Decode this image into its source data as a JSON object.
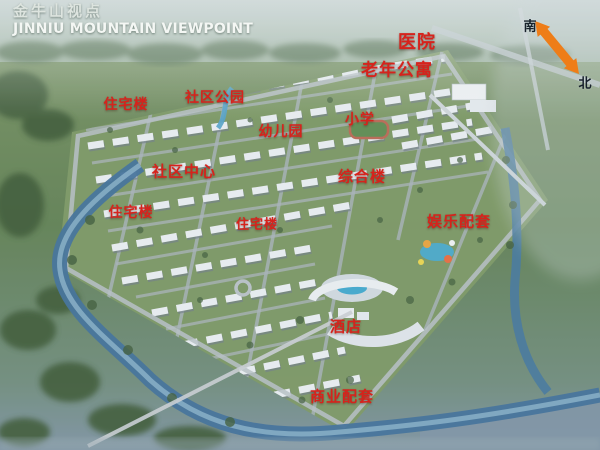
{
  "title": {
    "zh": "金牛山视点",
    "en": "JINNIU MOUNTAIN VIEWPOINT"
  },
  "compass": {
    "arrow_color": "#ee7d18",
    "south": {
      "text": "南",
      "x": 530,
      "y": 25
    },
    "north": {
      "text": "北",
      "x": 585,
      "y": 82
    }
  },
  "labels": [
    {
      "text": "医院",
      "x": 417,
      "y": 41,
      "size": 18
    },
    {
      "text": "老年公寓",
      "x": 397,
      "y": 68,
      "size": 17
    },
    {
      "text": "住宅楼",
      "x": 126,
      "y": 104,
      "size": 14
    },
    {
      "text": "社区公园",
      "x": 215,
      "y": 97,
      "size": 14
    },
    {
      "text": "小学",
      "x": 360,
      "y": 119,
      "size": 14
    },
    {
      "text": "幼儿园",
      "x": 281,
      "y": 131,
      "size": 14
    },
    {
      "text": "社区中心",
      "x": 184,
      "y": 171,
      "size": 15
    },
    {
      "text": "综合楼",
      "x": 362,
      "y": 176,
      "size": 15
    },
    {
      "text": "住宅楼",
      "x": 131,
      "y": 212,
      "size": 14
    },
    {
      "text": "住宅楼",
      "x": 257,
      "y": 223,
      "size": 13
    },
    {
      "text": "娱乐配套",
      "x": 459,
      "y": 221,
      "size": 15
    },
    {
      "text": "酒店",
      "x": 346,
      "y": 326,
      "size": 15
    },
    {
      "text": "商业配套",
      "x": 342,
      "y": 396,
      "size": 15
    }
  ],
  "colors": {
    "label_red": "#d6231c",
    "title_white": "#f4f7f4",
    "compass_orange": "#ee7d18",
    "river_blue": "#3e6f99",
    "ground_green": "#6b8a5d"
  }
}
